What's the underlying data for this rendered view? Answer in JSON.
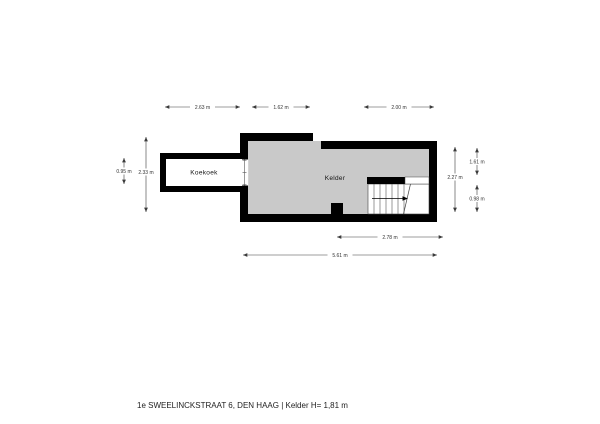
{
  "caption": "1e SWEELINCKSTRAAT 6, DEN HAAG  | Kelder H= 1,81 m",
  "rooms": {
    "koekoek": {
      "label": "Koekoek"
    },
    "kelder": {
      "label": "Kelder"
    }
  },
  "dimensions": {
    "top_koekoek": "2.63 m",
    "top_middle": "1.62 m",
    "top_right": "2.00 m",
    "left_inner": "0.95 m",
    "left_outer": "2.33 m",
    "right_inner": "2.27 m",
    "right_top": "1.61 m",
    "right_bottom": "0.98 m",
    "bottom_inner": "2.78 m",
    "bottom_outer": "5.61 m"
  },
  "colors": {
    "wall": "#000000",
    "kelder_fill": "#c9c9c9",
    "koekoek_fill": "#ffffff",
    "background": "#ffffff"
  }
}
